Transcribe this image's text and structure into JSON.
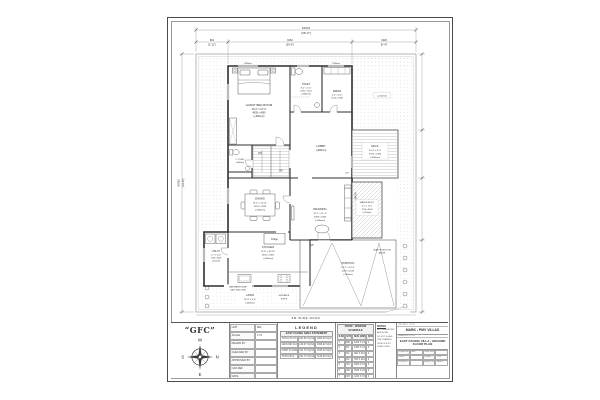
{
  "logo": {
    "text": "“GFC”"
  },
  "compass": {
    "top": "W",
    "left": "S",
    "right": "N",
    "bottom": "E"
  },
  "dims": {
    "top_total_mm": "10972",
    "top_total_ft": "[36'-0\"]",
    "seg1_mm": "891",
    "seg1_ft": "[2'-11\"]",
    "seg2_mm": "8152",
    "seg2_ft": "[26'-9\"]",
    "seg3_mm": "1929",
    "seg3_ft": "[6'-4\"]",
    "left_mm": "10592",
    "left_ft": "[34'-9\"]",
    "road": "9M WIDE ROAD"
  },
  "rooms": {
    "guest_bed": {
      "name": "GUEST BED ROOM",
      "ft": "16'-2\" x 13'-4\"",
      "mm": "4935 x 4065",
      "lvl": "(+900mm)"
    },
    "toilet": {
      "name": "TOILET",
      "ft": "8'-2\" x 5'-0\"",
      "mm": "2490 x 1524",
      "lvl": "(+880mm)"
    },
    "dress": {
      "name": "DRESS",
      "ft": "5'-0\" x 8'-0\"",
      "mm": "1524 x 2438"
    },
    "lobby": {
      "name": "LOBBY",
      "lvl": "(+900mm)"
    },
    "deck": {
      "name": "DECK",
      "ft": "12'-4\" x 8'-0\"",
      "mm": "3743 x 2436",
      "lvl": "(+900mm)"
    },
    "dining": {
      "name": "DINING",
      "ft": "14'-6\" x 10'-11\"",
      "mm": "4424 x 3328",
      "lvl": "(+900mm)"
    },
    "drawing": {
      "name": "DRAWING",
      "ft": "10'-1\" x 11'-4\"",
      "mm": "3029 x 3446",
      "lvl": "(+900mm)"
    },
    "water_body": {
      "name": "WATER BODY",
      "ft": "5'-2\" x 11'-2\"",
      "mm": "1574 x 3406",
      "lvl": "(-450mm)"
    },
    "kitchen": {
      "name": "KITCHEN",
      "ft": "11'-8\" x 10'-10\"",
      "mm": "3545 x 3303",
      "lvl": "(+900mm)"
    },
    "utility": {
      "name": "UTILITY",
      "ft": "5'-7\" x 11'-2\"",
      "mm": "1706 x 3403",
      "lvl": "(-150mm)"
    },
    "c_toilet": {
      "name": "C.TOILET",
      "lvl": "(+880mm)"
    },
    "lawn": {
      "name": "LAWN",
      "ft": "18'-4\" x 9'-6\"",
      "lvl": "(-450mm)"
    },
    "lawn_right": {
      "lvl": "(+150mm)"
    },
    "portico": {
      "name": "PORTICO",
      "ft": "16'-7\" x 13'-6\"",
      "mm": "5057 x 4134",
      "lvl": "(-150mm)"
    }
  },
  "annot": {
    "up": "UP",
    "dn": "DN",
    "fridge": "Fridge",
    "wash": "WASH",
    "rain1": "RAIN WATER SUMP",
    "rain2": "(CAP: 8000 LTRS)",
    "proj1": "SLAB PROJECTION",
    "proj2": "ABOVE",
    "entry1": "ENTRANCE",
    "entry2": "STEPS",
    "win1": "1800mm",
    "win2": "1500mm"
  },
  "title_block": {
    "info_rows": [
      [
        "UNIT",
        "MM"
      ],
      [
        "SCALE",
        "1:75"
      ],
      [
        "DRAWN BY",
        ""
      ],
      [
        "CHECKED BY",
        ""
      ],
      [
        "APPROVED BY",
        ""
      ],
      [
        "CAD REF",
        ""
      ],
      [
        "DATE",
        ""
      ],
      [
        "REVISION",
        "R0"
      ]
    ],
    "legend_title": "LEGEND",
    "area_statement": {
      "title": "EAST FACING AREA STATEMENT",
      "rows": [
        [
          "TOTAL PLOT AREA",
          "222.96 SQ.M(s)",
          "2400.00 SQ.FT"
        ],
        [
          "GROUND FLOOR",
          "139.97 SQ.M(s)",
          "1506.62 SQ.FT"
        ],
        [
          "FIRST FLOOR",
          "151.75 SQ.M(s)",
          "1633.43 SQ.FT"
        ],
        [
          "TOTAL BUA",
          "291.72 SQ.M(s)",
          "3140.05 SQ.FT"
        ]
      ]
    },
    "schedule": {
      "title": "DOOR - WINDOW SCHEDULE",
      "header": [
        "S.NO",
        "SYM",
        "SIZE (MM)",
        "NOS"
      ],
      "rows": [
        [
          "1",
          "MD",
          "1200 X 2100",
          "1"
        ],
        [
          "2",
          "D1",
          "1050 X 2100",
          "2"
        ],
        [
          "3",
          "D2",
          "900 X 2100",
          "4"
        ],
        [
          "4",
          "D3",
          "750 X 2100",
          "2"
        ],
        [
          "5",
          "W1",
          "1800 X 1500",
          "3"
        ],
        [
          "6",
          "W2",
          "1500 X 1500",
          "2"
        ],
        [
          "7",
          "W3",
          "1200 X 1500",
          "2"
        ],
        [
          "8",
          "V1",
          "600 X 600",
          "2"
        ],
        [
          "9",
          "SD",
          "2400 X 2100",
          "1"
        ],
        [
          "10",
          "G1",
          "3600 X 1500",
          "1"
        ]
      ]
    },
    "notes": {
      "title": "NOTES",
      "lines": [
        "ALL DIMENSIONS ARE IN MM",
        "DO NOT SCALE THE DRAWING",
        "LEVELS W.R.T ROAD LEVEL"
      ]
    },
    "project": {
      "project_label": "PROJECT TITLE",
      "project_value": "MARK - PMV VILLAS",
      "drawing_label": "DRAWING TITLE",
      "drawing_value": "EAST FACING VILLA - GROUND FLOOR PLAN",
      "field_rows": [
        [
          "DRAWN BY",
          "GFC",
          "CHECKED BY",
          ""
        ],
        [
          "DATE",
          "",
          "SCALE",
          "1:75"
        ],
        [
          "PROJECT NO",
          "",
          "SHEET NO",
          "GF-01"
        ]
      ]
    }
  }
}
